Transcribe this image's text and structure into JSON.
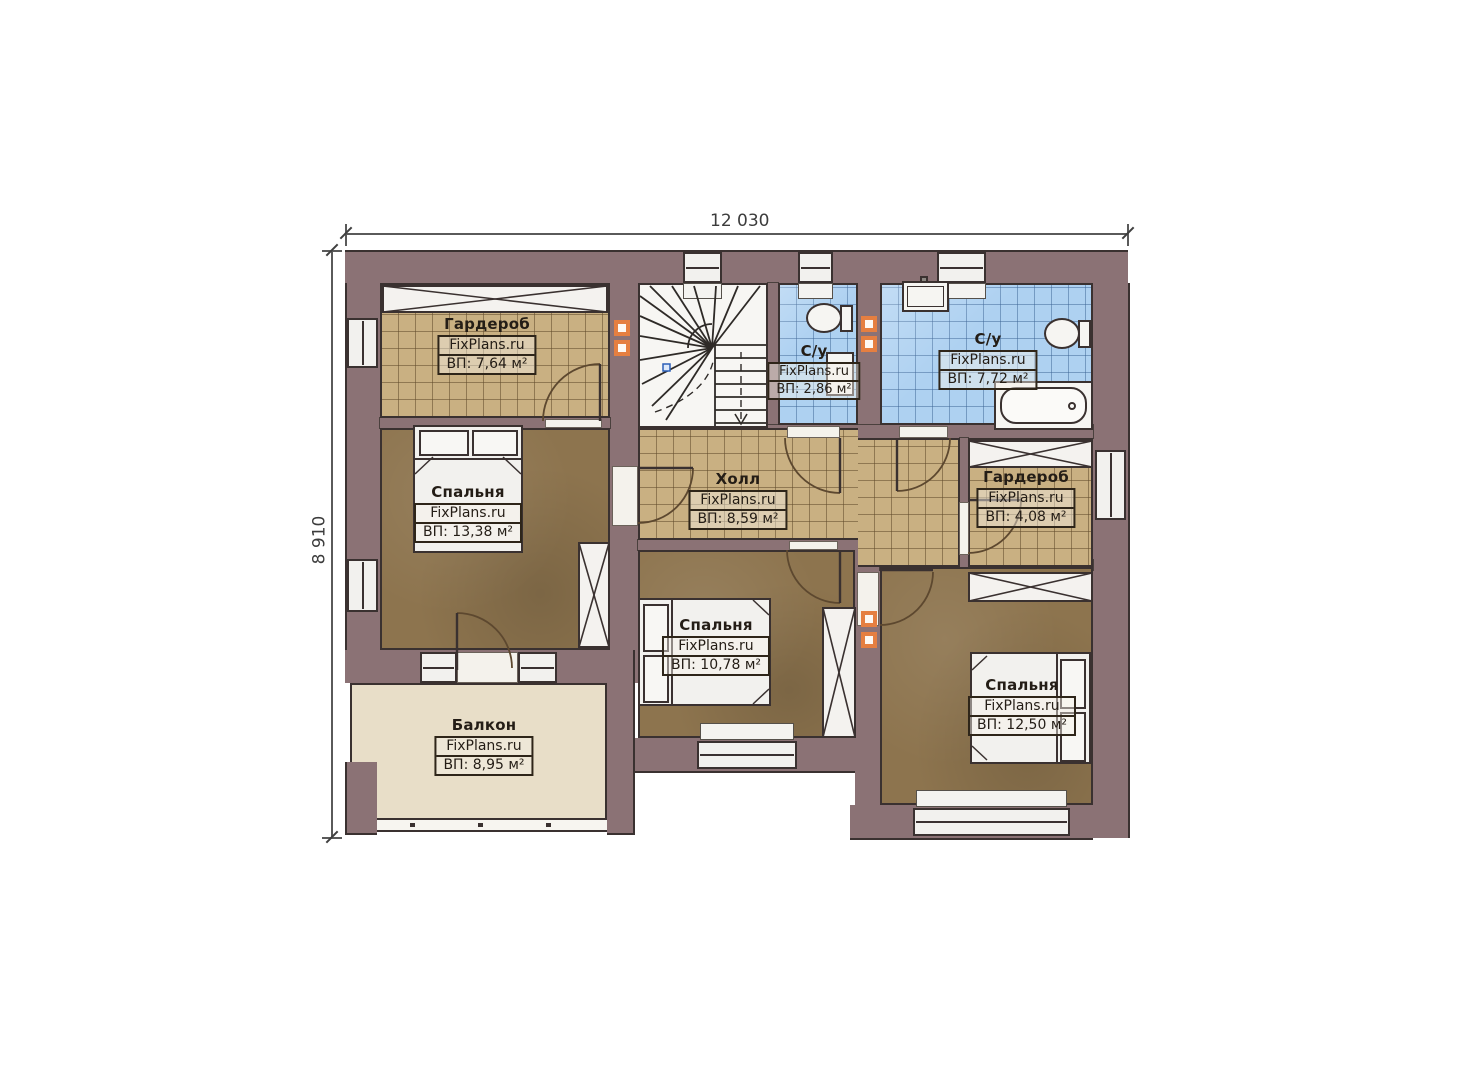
{
  "plan": {
    "title": "Second floor plan",
    "watermark": "FixPlans.ru",
    "dimensions": {
      "width_label": "12 030",
      "height_label": "8 910"
    },
    "palette": {
      "wall": "#8b7275",
      "line": "#3a3130",
      "floor_wood": "#8d744e",
      "tile_tan": "#c9b082",
      "tile_blue": "#aed1f1",
      "balcony_floor": "#e8dec8",
      "vent_orange": "#e57f41"
    },
    "rooms": [
      {
        "id": "wardrobe-top-left",
        "name": "Гардероб",
        "watermark": "FixPlans.ru",
        "area": "ВП: 7,64 м²"
      },
      {
        "id": "bathroom-small",
        "name": "С/у",
        "watermark": "FixPlans.ru",
        "area": "ВП: 2,86 м²"
      },
      {
        "id": "bathroom-large",
        "name": "С/у",
        "watermark": "FixPlans.ru",
        "area": "ВП: 7,72 м²"
      },
      {
        "id": "bedroom-left",
        "name": "Спальня",
        "watermark": "FixPlans.ru",
        "area": "ВП: 13,38 м²"
      },
      {
        "id": "hall",
        "name": "Холл",
        "watermark": "FixPlans.ru",
        "area": "ВП: 8,59 м²"
      },
      {
        "id": "wardrobe-right",
        "name": "Гардероб",
        "watermark": "FixPlans.ru",
        "area": "ВП: 4,08 м²"
      },
      {
        "id": "bedroom-middle",
        "name": "Спальня",
        "watermark": "FixPlans.ru",
        "area": "ВП: 10,78 м²"
      },
      {
        "id": "bedroom-right",
        "name": "Спальня",
        "watermark": "FixPlans.ru",
        "area": "ВП: 12,50 м²"
      },
      {
        "id": "balcony",
        "name": "Балкон",
        "watermark": "FixPlans.ru",
        "area": "ВП: 8,95 м²"
      }
    ]
  }
}
